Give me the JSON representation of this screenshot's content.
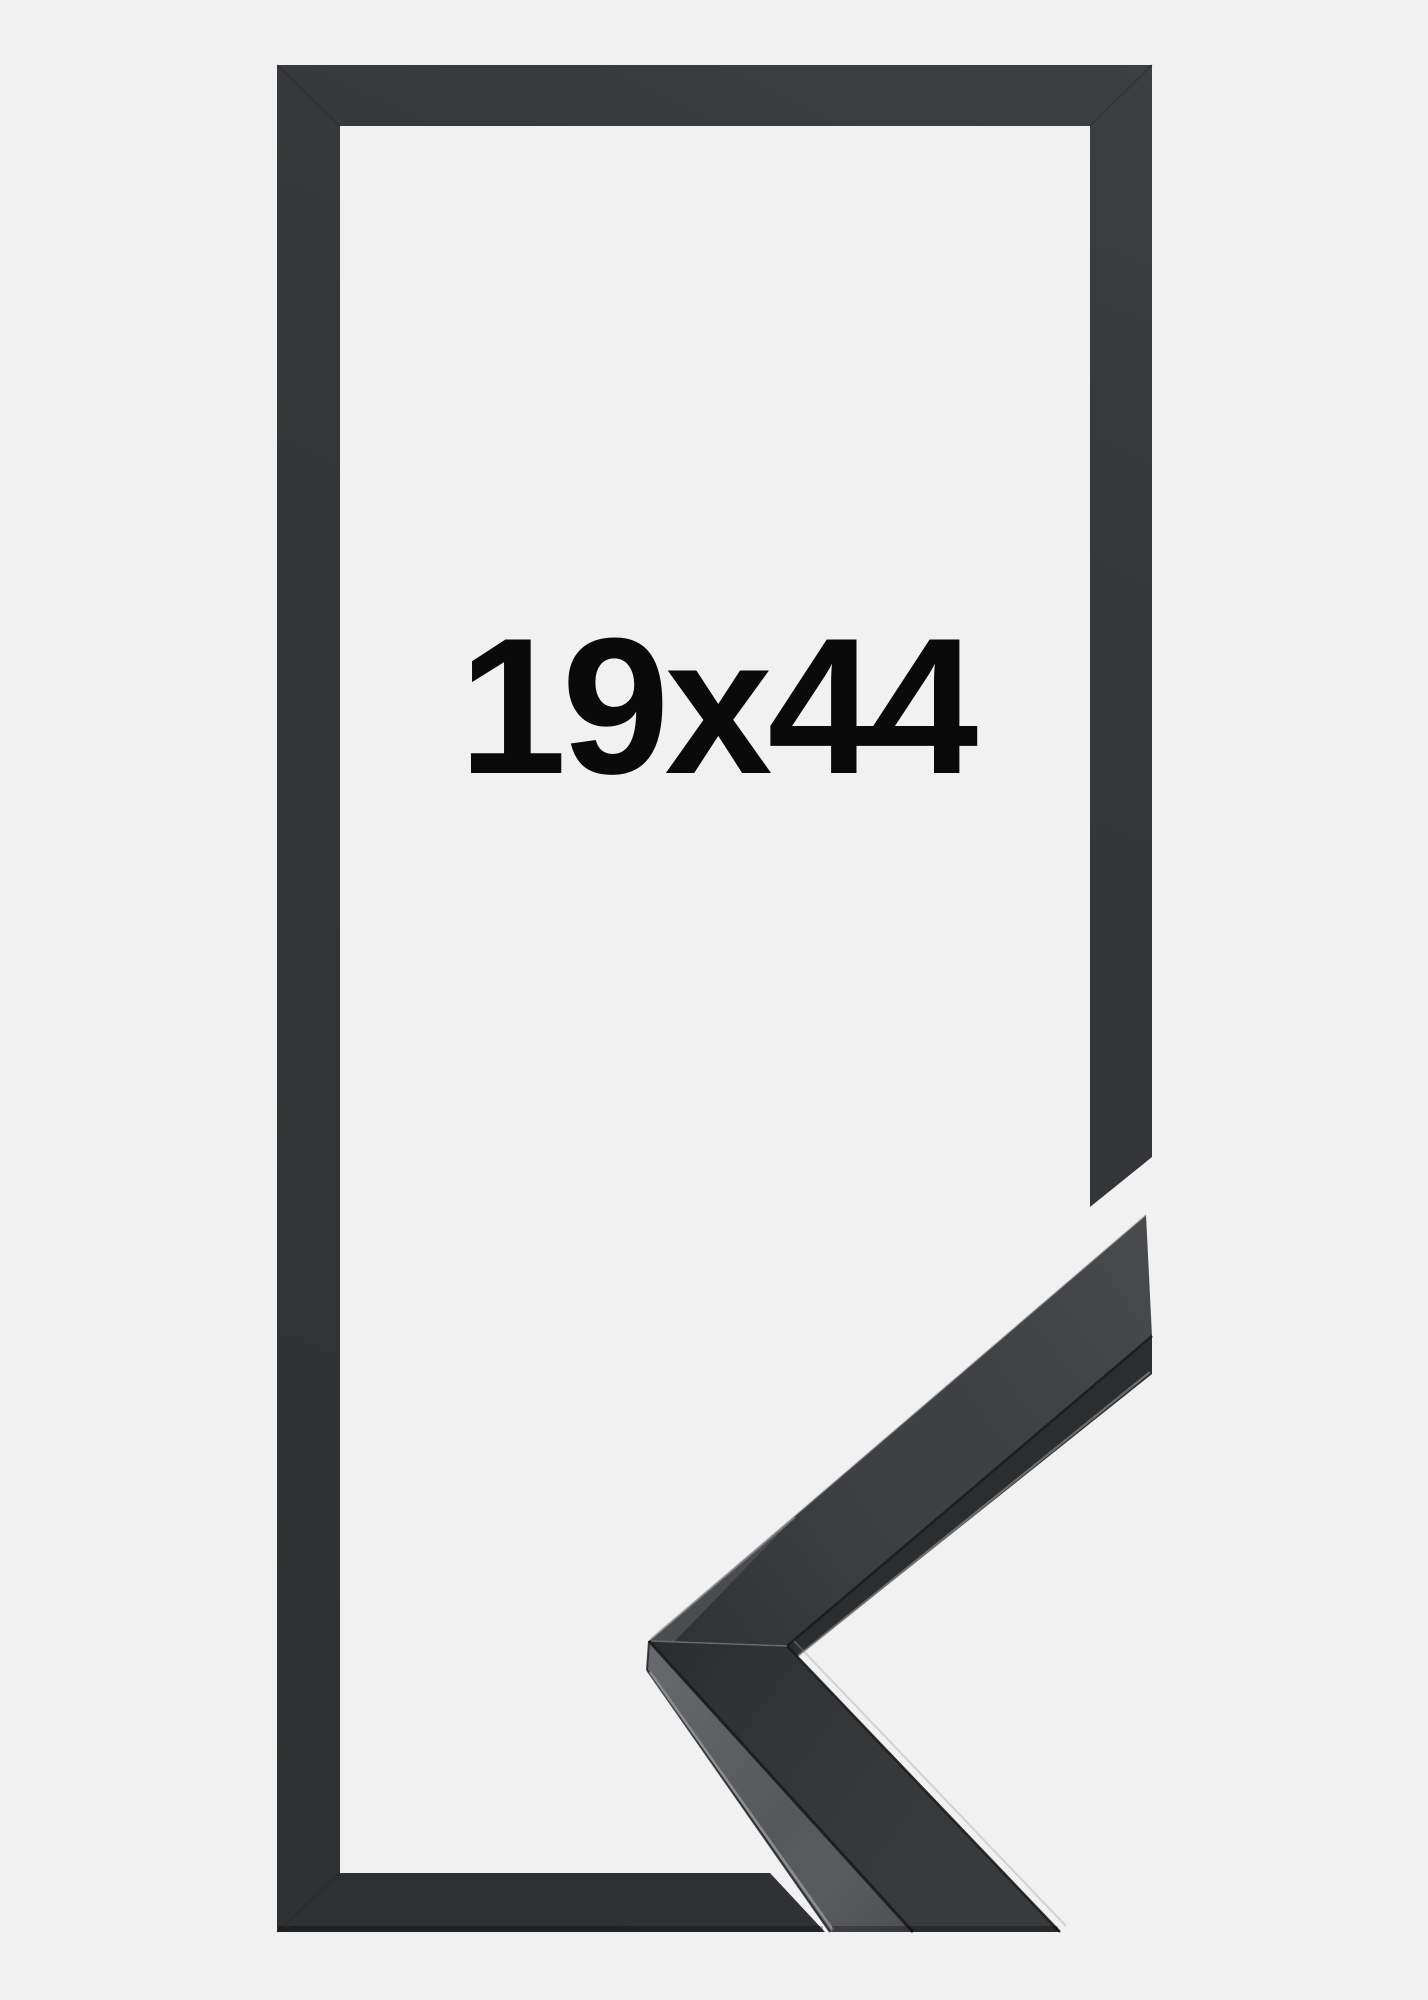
{
  "image": {
    "size_label": "19x44",
    "alt": "Black picture frame shown flat with a mitered corner profile sample overlapping its lower right corner"
  },
  "colors": {
    "background": "#f1f1f2",
    "frame": "#333538",
    "sample_upper_face": "#3e4043",
    "sample_lower_face": "#2f3133",
    "sample_side_face": "#55575b",
    "sample_rabbet": "#2b2d2f",
    "sample_sliver": "#4a4c4f",
    "edge_highlight": "#97999c",
    "seam": "#1a1b1d",
    "label_text": "#0a0a0b"
  }
}
